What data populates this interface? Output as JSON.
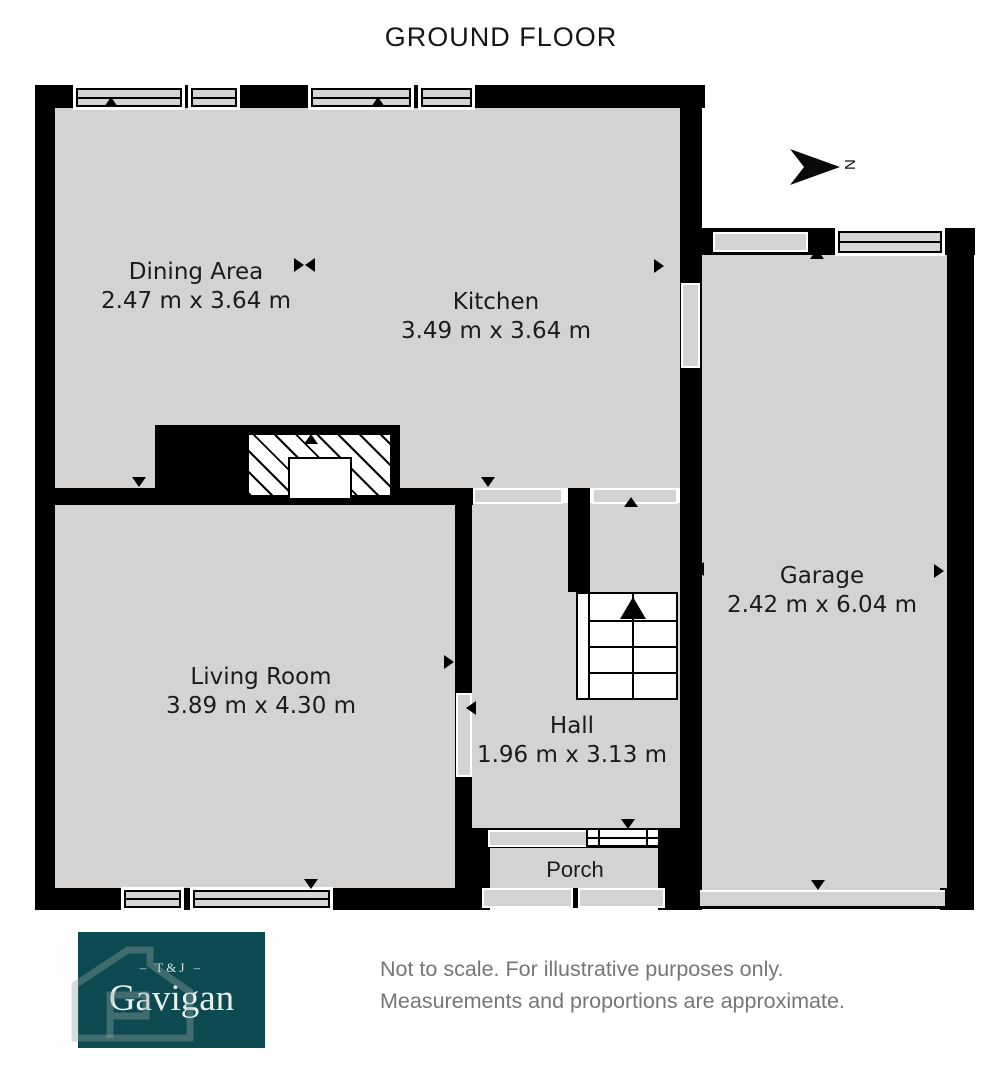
{
  "title": "GROUND FLOOR",
  "compass": {
    "letter": "N"
  },
  "rooms": [
    {
      "id": "dining",
      "name": "Dining Area",
      "dims": "2.47 m x 3.64 m"
    },
    {
      "id": "kitchen",
      "name": "Kitchen",
      "dims": "3.49 m x 3.64 m"
    },
    {
      "id": "garage",
      "name": "Garage",
      "dims": "2.42 m x 6.04 m"
    },
    {
      "id": "living",
      "name": "Living Room",
      "dims": "3.89 m x 4.30 m"
    },
    {
      "id": "hall",
      "name": "Hall",
      "dims": "1.96 m x 3.13 m"
    },
    {
      "id": "porch",
      "name": "Porch",
      "dims": ""
    }
  ],
  "branding": {
    "logo_prefix": "– T&J –",
    "logo_name": "Gavigan"
  },
  "disclaimer": {
    "line1": "Not to scale. For illustrative purposes only.",
    "line2": "Measurements and proportions are approximate."
  },
  "colors": {
    "wall": "#000000",
    "floor": "#d4d3d1",
    "logo_bg": "#0d4950",
    "logo_text": "#e9f1ee",
    "disclaimer_text": "#767676",
    "title_text": "#161616"
  }
}
